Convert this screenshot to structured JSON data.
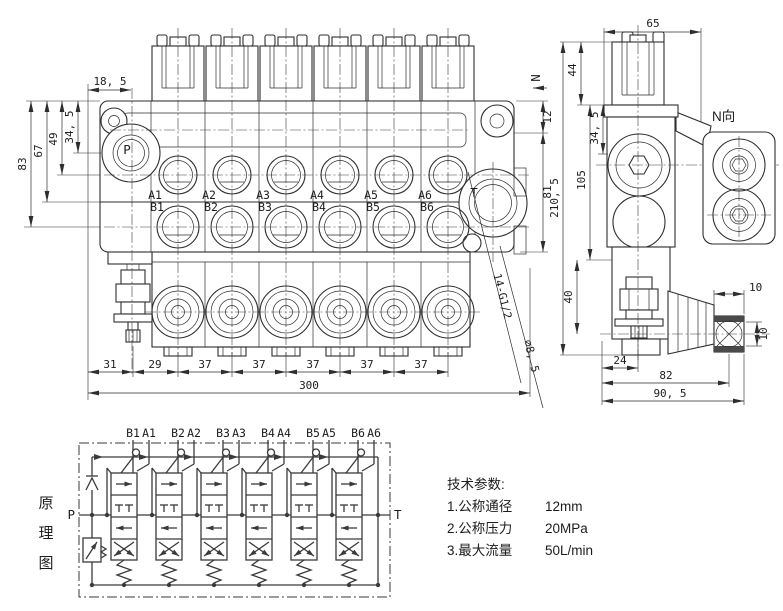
{
  "front_view": {
    "labels": {
      "p": "P",
      "t": "T",
      "n_arrow": "N"
    },
    "a_ports": [
      "A1",
      "A2",
      "A3",
      "A4",
      "A5",
      "A6"
    ],
    "b_ports": [
      "B1",
      "B2",
      "B3",
      "B4",
      "B5",
      "B6"
    ],
    "dims": {
      "top": "18, 5",
      "left_34_5": "34, 5",
      "left_49": "49",
      "left_67": "67",
      "left_83": "83",
      "right_12": "12",
      "right_81": "81",
      "bottom": [
        "31",
        "29",
        "37",
        "37",
        "37",
        "37",
        "37"
      ],
      "total_width": "300",
      "thread_callout": "14-G1/2",
      "hole_callout": "∅8, 5"
    }
  },
  "side_view": {
    "dims": {
      "top_width": "65",
      "cap_height": "44",
      "flange": "34, 5",
      "body": "105",
      "total_height": "210, 5",
      "relief_drop": "40",
      "bottom_24": "24",
      "bottom_82": "82",
      "bottom_90_5": "90, 5",
      "joint_w": "10",
      "joint_h": "10"
    }
  },
  "n_view": {
    "label": "N向"
  },
  "schematic": {
    "title": [
      "原",
      "理",
      "图"
    ],
    "p": "P",
    "t": "T",
    "sections": [
      {
        "b": "B1",
        "a": "A1"
      },
      {
        "b": "B2",
        "a": "A2"
      },
      {
        "b": "B3",
        "a": "A3"
      },
      {
        "b": "B4",
        "a": "A4"
      },
      {
        "b": "B5",
        "a": "A5"
      },
      {
        "b": "B6",
        "a": "A6"
      }
    ]
  },
  "tech_specs": {
    "title": "技术参数:",
    "items": [
      {
        "name": "1.公称通径",
        "value": "12mm"
      },
      {
        "name": "2.公称压力",
        "value": "20MPa"
      },
      {
        "name": "3.最大流量",
        "value": "50L/min"
      }
    ]
  }
}
